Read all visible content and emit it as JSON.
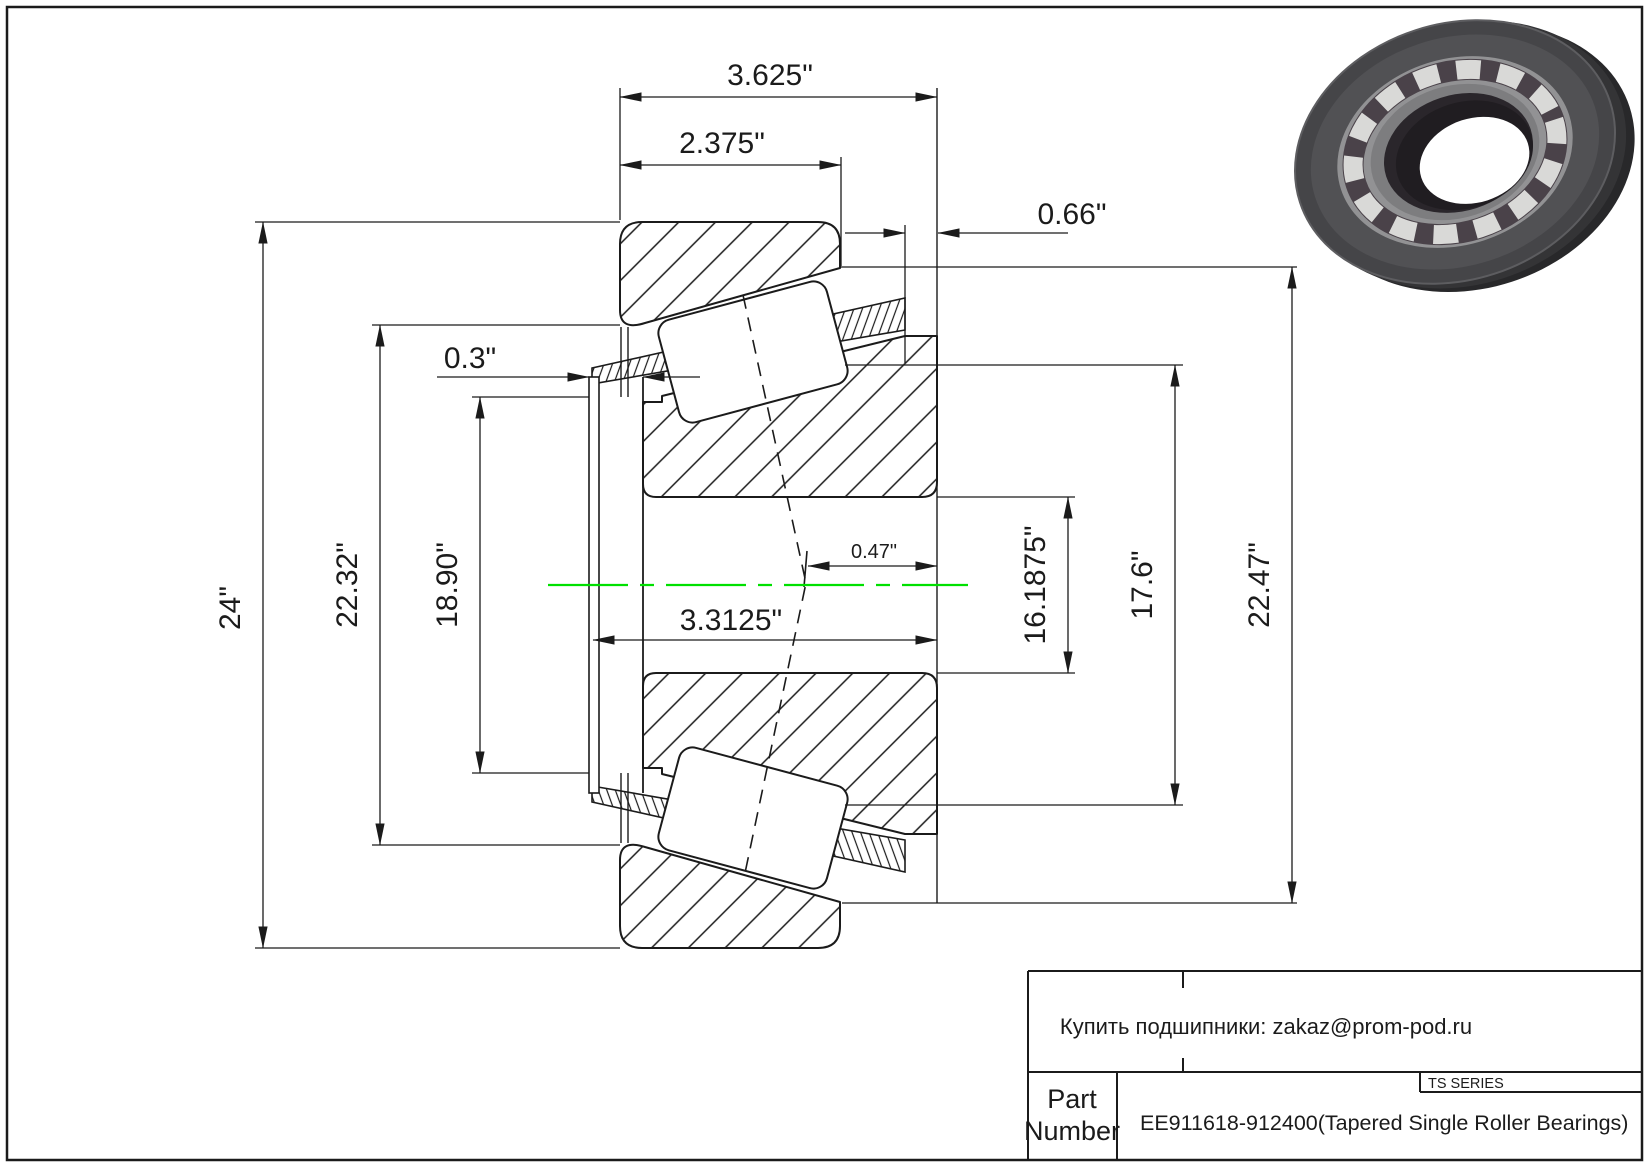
{
  "drawing": {
    "type": "tapered-single-roller-bearing-cross-section",
    "dims": {
      "overall_width": "3.625\"",
      "cup_width": "2.375\"",
      "cone_back_overhang": "0.66\"",
      "front_protrusion": "0.3\"",
      "effective_center_offset": "0.47\"",
      "cone_assembly_width": "3.3125\"",
      "outer_extreme_diameter": "24\"",
      "flange_diameter": "22.32\"",
      "shoulder_diameter": "18.90\"",
      "bore_diameter": "16.1875\"",
      "rib_diameter": "17.6\"",
      "cup_outer_diameter": "22.47\""
    }
  },
  "title_block": {
    "contact_note": "Купить подшипники: zakaz@prom-pod.ru",
    "series_label": "TS SERIES",
    "part_label_line1": "Part",
    "part_label_line2": "Number",
    "part_number": "EE911618-912400(Tapered Single Roller Bearings)"
  },
  "colors": {
    "centerline_green": "#00e000",
    "line_color": "#1b1b1b",
    "bearing_render_dark": "#3a3a3d",
    "bearing_render_cage": "#929294",
    "bearing_render_roller": "#d9d9d7"
  }
}
